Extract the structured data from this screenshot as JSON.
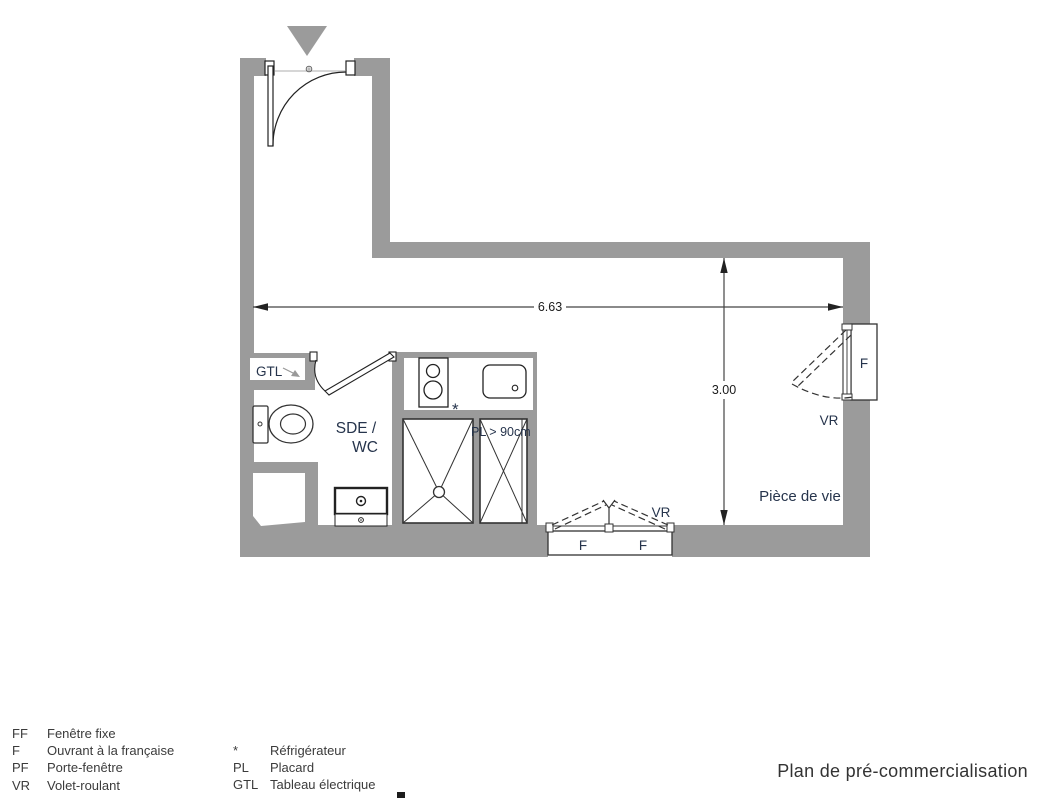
{
  "title": "Plan de pré-commercialisation",
  "plan": {
    "labels": {
      "gtl": "GTL",
      "sde_wc_line1": "SDE /",
      "sde_wc_line2": "WC",
      "placard_min_width": "PL > 90cm",
      "fridge_marker": "*",
      "dim_width": "6.63",
      "dim_height": "3.00",
      "window_right_f": "F",
      "window_right_vr": "VR",
      "window_bottom_f1": "F",
      "window_bottom_f2": "F",
      "window_bottom_vr": "VR",
      "living_room": "Pièce de vie"
    },
    "colors": {
      "wall": "#9b9b9b",
      "label": "#26344c",
      "line": "#333333",
      "dimension": "#1a1a1a"
    }
  },
  "legend": {
    "left": [
      {
        "abbr": "FF",
        "label": "Fenêtre fixe"
      },
      {
        "abbr": "F",
        "label": "Ouvrant à la française"
      },
      {
        "abbr": "PF",
        "label": "Porte-fenêtre"
      },
      {
        "abbr": "VR",
        "label": "Volet-roulant"
      }
    ],
    "right": [
      {
        "abbr": "*",
        "label": "Réfrigérateur"
      },
      {
        "abbr": "PL",
        "label": "Placard"
      },
      {
        "abbr": "GTL",
        "label": "Tableau électrique"
      }
    ]
  }
}
